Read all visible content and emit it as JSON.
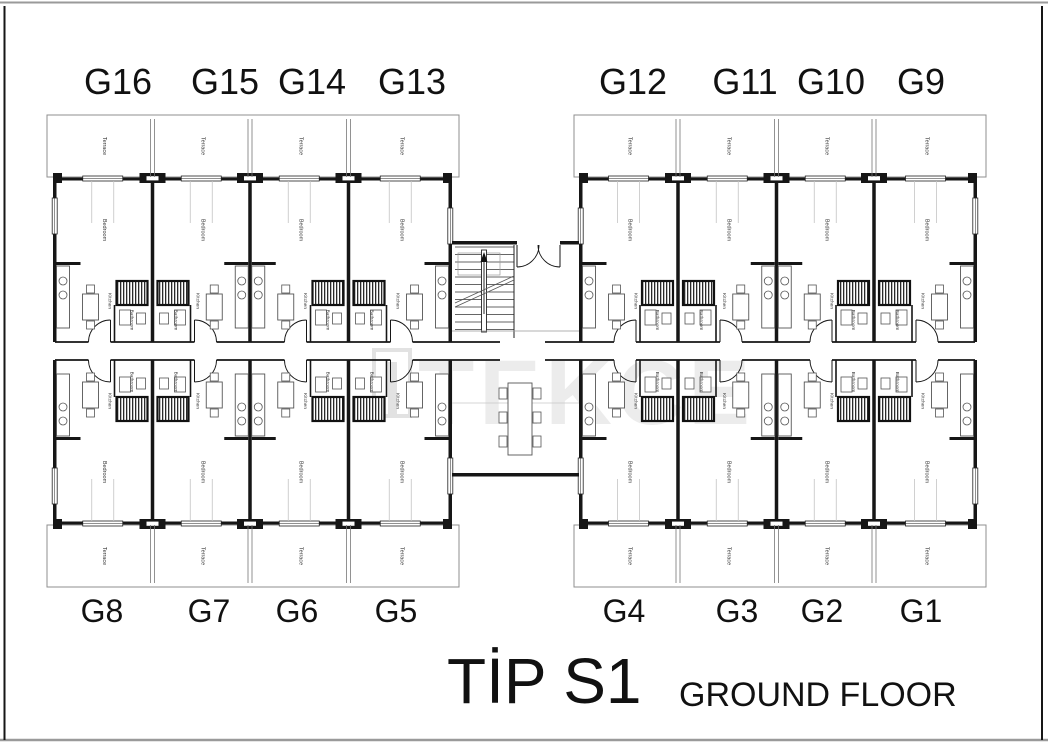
{
  "page": {
    "title": "TİP S1",
    "subtitle": "GROUND FLOOR",
    "watermark": "TEKCE",
    "background": "#ffffff"
  },
  "plan": {
    "room_labels": {
      "terrace": "Terrace",
      "bedroom": "Bedroom",
      "kitchen": "Kitchen",
      "bathroom": "Bathroom"
    },
    "units": {
      "top_left": [
        "G16",
        "G15",
        "G14",
        "G13"
      ],
      "top_right": [
        "G12",
        "G11",
        "G10",
        "G9"
      ],
      "bottom_left": [
        "G8",
        "G7",
        "G6",
        "G5"
      ],
      "bottom_right": [
        "G4",
        "G3",
        "G2",
        "G1"
      ]
    }
  },
  "colors": {
    "wall": "#161616",
    "furniture": "#555555",
    "light_line": "#9a9a9a",
    "terrace_line": "#8f8f8f",
    "curtain_line": "#c4c4c4",
    "watermark": "#ececec",
    "watermark_logo": "#e2e2e2",
    "label": "#111111",
    "room_label": "#3a3a3a"
  }
}
